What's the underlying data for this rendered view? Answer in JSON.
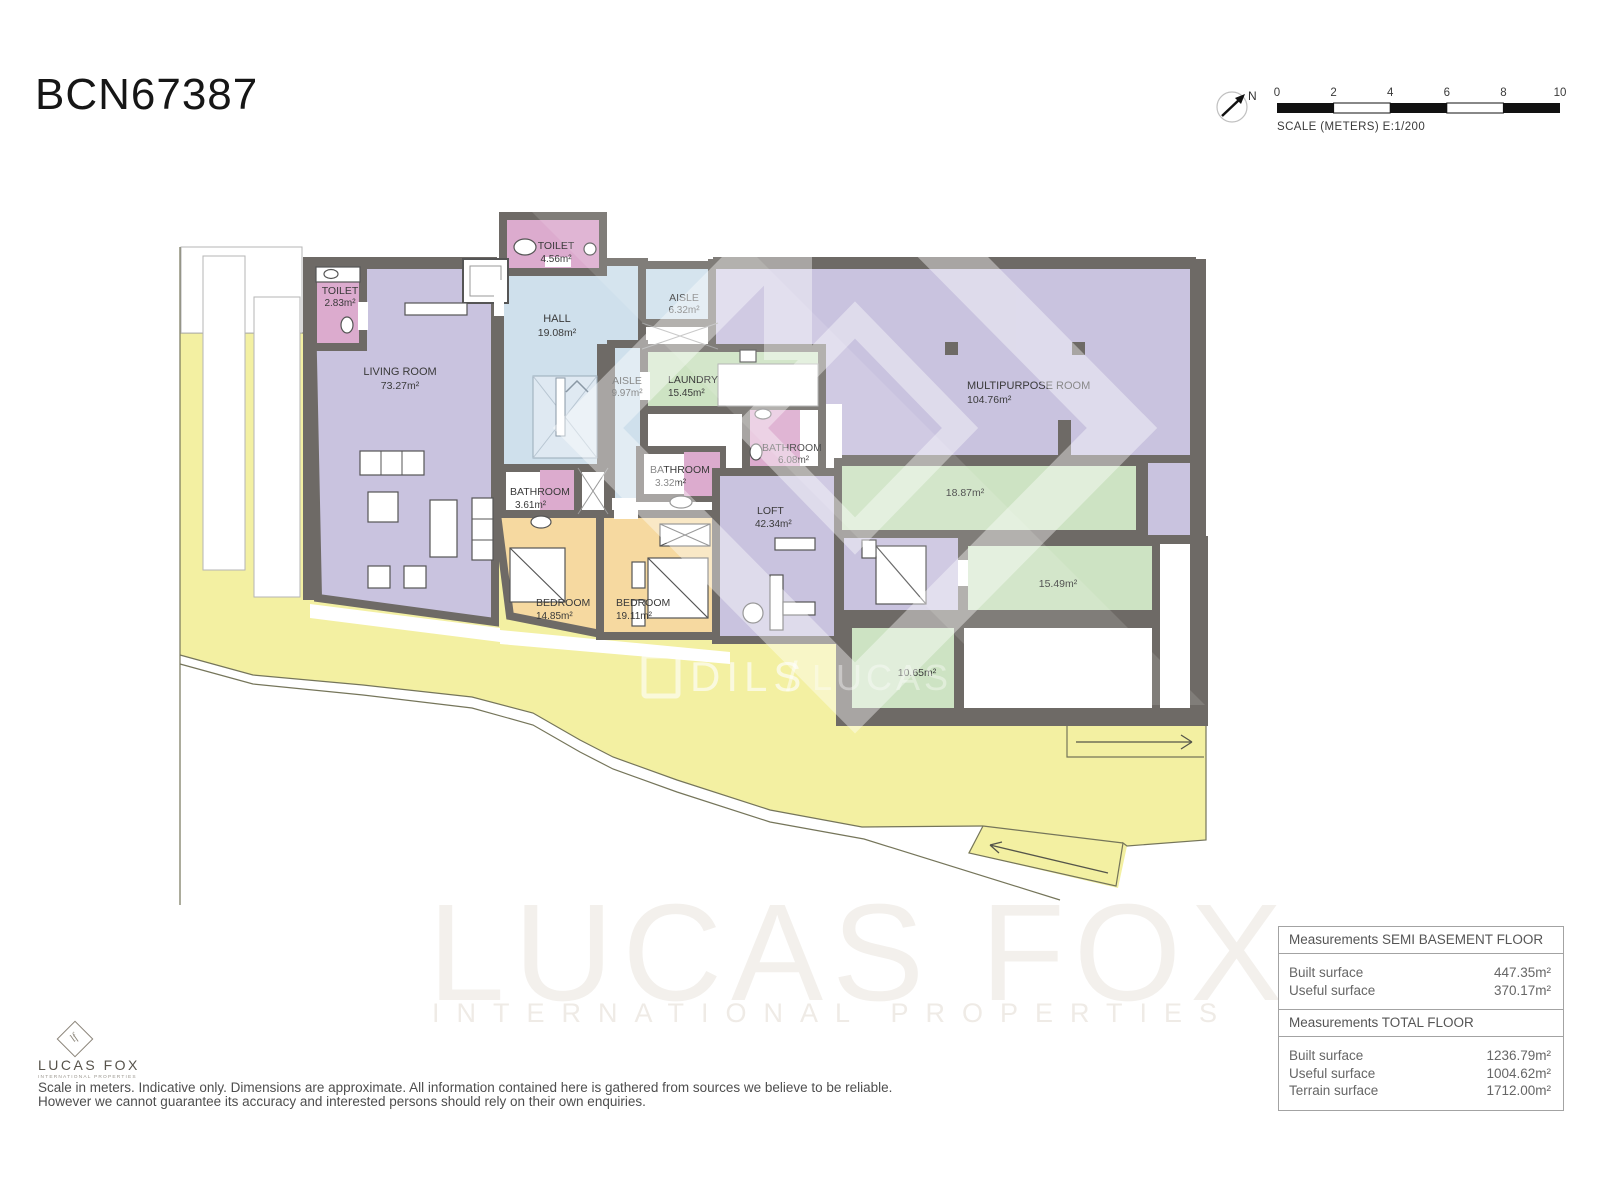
{
  "header": {
    "title": "BCN67387"
  },
  "compass": {
    "north_label": "N"
  },
  "scale_bar": {
    "ticks": [
      "0",
      "2",
      "4",
      "6",
      "8",
      "10"
    ],
    "caption": "SCALE (METERS) E:1/200"
  },
  "rooms": {
    "toilet_top": {
      "name": "TOILET",
      "area": "4.56m²"
    },
    "toilet_left": {
      "name": "TOILET",
      "area": "2.83m²"
    },
    "hall": {
      "name": "HALL",
      "area": "19.08m²"
    },
    "living_room": {
      "name": "LIVING ROOM",
      "area": "73.27m²"
    },
    "aisle_upper": {
      "name": "AISLE",
      "area": "6.32m²"
    },
    "aisle_lower": {
      "name": "AISLE",
      "area": "9.97m²"
    },
    "laundry": {
      "name": "LAUNDRY",
      "area": "15.45m²"
    },
    "multipurpose_room": {
      "name": "MULTIPURPOSE ROOM",
      "area": "104.76m²"
    },
    "bathroom_large": {
      "name": "BATHROOM",
      "area": "6.08m²"
    },
    "bathroom_small": {
      "name": "BATHROOM",
      "area": "3.32m²"
    },
    "bathroom_bedroom": {
      "name": "BATHROOM",
      "area": "3.61m²"
    },
    "loft": {
      "name": "LOFT",
      "area": "42.34m²"
    },
    "bedroom_left": {
      "name": "BEDROOM",
      "area": "14.85m²"
    },
    "bedroom_right": {
      "name": "BEDROOM",
      "area": "19.11m²"
    },
    "terrace_upper": {
      "area": "18.87m²"
    },
    "terrace_right": {
      "area": "15.49m²"
    },
    "terrace_lower": {
      "area": "10.65m²"
    }
  },
  "watermarks": {
    "dils": "DILS",
    "dils_divider": "/",
    "dils_partner": "LUCAS FOX",
    "brand": "LUCAS FOX",
    "brand_sub": "INTERNATIONAL PROPERTIES"
  },
  "footer_logo": {
    "monogram": "lf",
    "brand": "LUCAS FOX",
    "subtitle": "INTERNATIONAL PROPERTIES"
  },
  "disclaimer": {
    "line1": "Scale in meters. Indicative only. Dimensions are approximate. All information contained here is gathered from sources we believe to be reliable.",
    "line2": "However we cannot guarantee its accuracy and interested persons should rely on their own enquiries."
  },
  "measurements": {
    "semi_basement": {
      "title": "Measurements SEMI BASEMENT FLOOR",
      "rows": [
        {
          "label": "Built surface",
          "value": "447.35m²"
        },
        {
          "label": "Useful surface",
          "value": "370.17m²"
        }
      ]
    },
    "total": {
      "title": "Measurements TOTAL FLOOR",
      "rows": [
        {
          "label": "Built surface",
          "value": "1236.79m²"
        },
        {
          "label": "Useful surface",
          "value": "1004.62m²"
        },
        {
          "label": "Terrain surface",
          "value": "1712.00m²"
        }
      ]
    }
  },
  "colors": {
    "wall": "#6e6a66",
    "terrain": "#f3f0a2",
    "room_lavender": "#c9c3df",
    "room_blue": "#cfe0ec",
    "room_green": "#cde3c3",
    "room_pink": "#dcabce",
    "room_orange": "#f6d9a0"
  }
}
